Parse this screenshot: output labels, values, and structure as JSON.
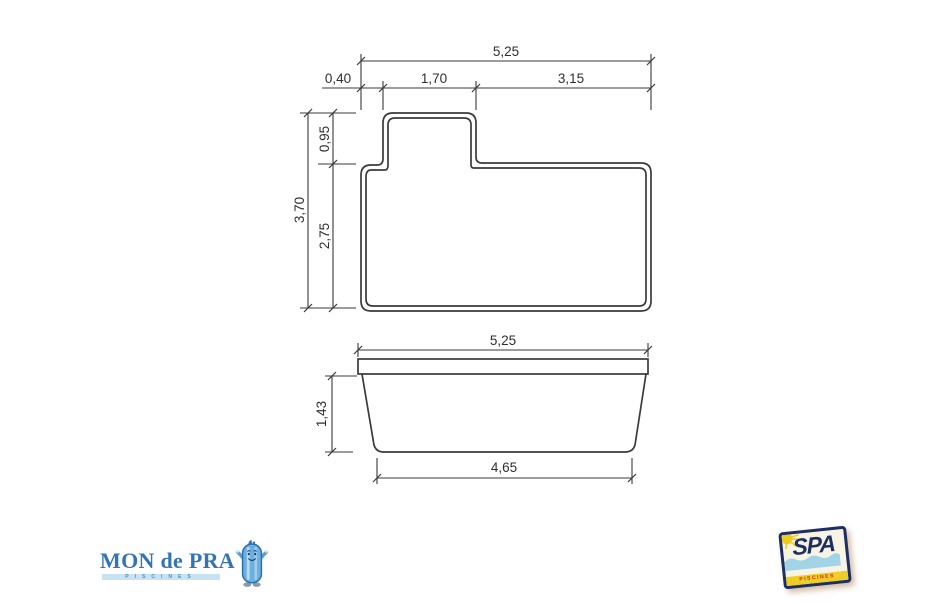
{
  "colors": {
    "drawing_line": "#3a3a3a",
    "dimension_text": "#2f2f2f",
    "mondepra_blue": "#3474b4",
    "mondepra_band_blue": "#c7e2f3",
    "spa_navy": "#1d2e63",
    "spa_yellow": "#eecd24",
    "spa_red": "#cf3420",
    "spa_water_blue": "#a2d4e8"
  },
  "plan_view": {
    "label_total_width": "5,25",
    "label_offset_left": "0,40",
    "label_notch_width": "1,70",
    "label_right_width": "3,15",
    "label_total_length": "3,70",
    "label_notch_length": "0,95",
    "label_main_length": "2,75"
  },
  "side_view": {
    "label_top_width": "5,25",
    "label_depth": "1,43",
    "label_bottom_width": "4,65"
  },
  "logos": {
    "mondepra_name": "MON de PRA",
    "mondepra_tagline": "PISCINES",
    "spa_name": "SPA",
    "spa_tagline": "PISCINES"
  }
}
